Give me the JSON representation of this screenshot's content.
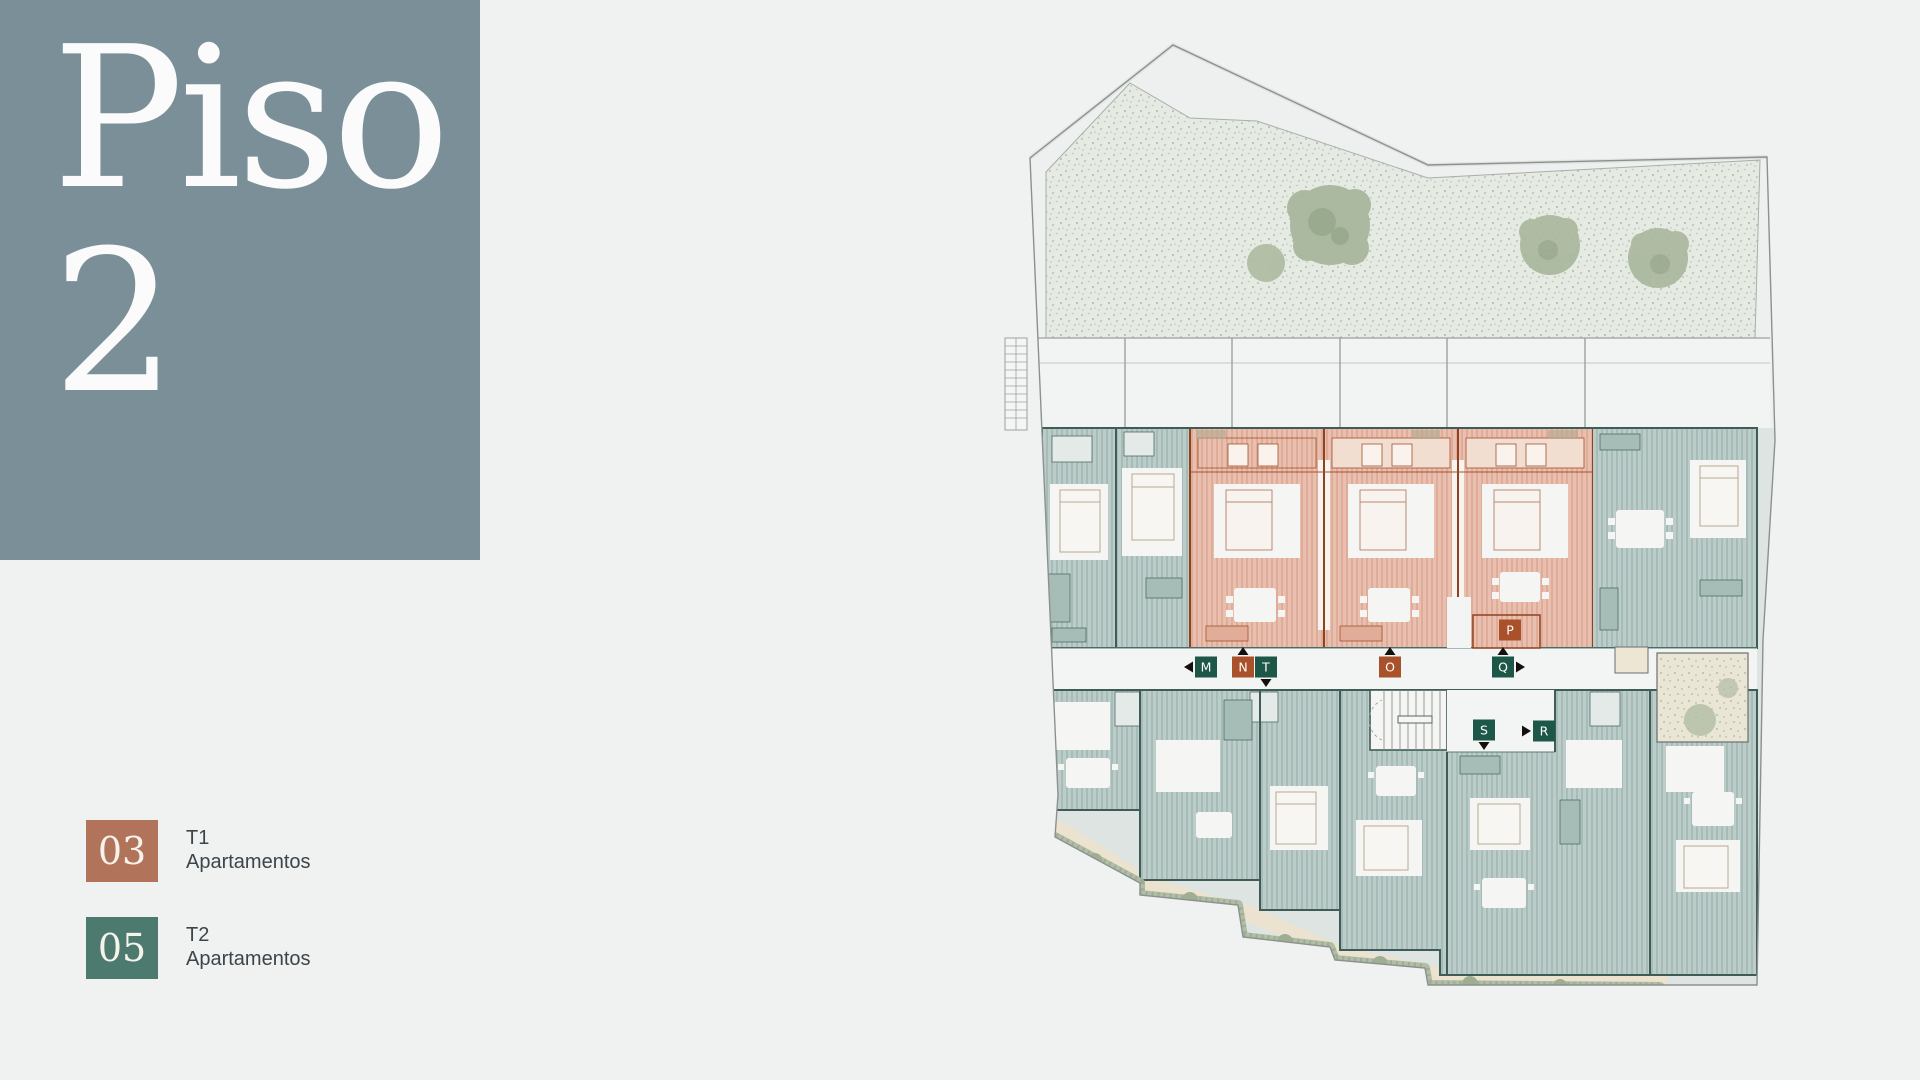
{
  "title_panel": {
    "line1": "Piso",
    "line2": "2",
    "background": "#7b8f99",
    "text_color": "#fafbfa"
  },
  "legend": {
    "items": [
      {
        "number": "03",
        "type_label": "T1",
        "category": "Apartamentos",
        "color": "#b1735a"
      },
      {
        "number": "05",
        "type_label": "T2",
        "category": "Apartamentos",
        "color": "#4d7a6e"
      }
    ]
  },
  "plan": {
    "label_colors": {
      "teal": "#1d5747",
      "orange": "#a9512a"
    },
    "unit_labels": [
      {
        "letter": "M",
        "style": "teal",
        "x": 206,
        "y": 627,
        "arrows": [
          "left"
        ]
      },
      {
        "letter": "N",
        "style": "orange",
        "x": 243,
        "y": 627,
        "arrows": [
          "up"
        ]
      },
      {
        "letter": "T",
        "style": "teal",
        "x": 266,
        "y": 627,
        "arrows": [
          "down"
        ]
      },
      {
        "letter": "O",
        "style": "orange",
        "x": 390,
        "y": 627,
        "arrows": [
          "up"
        ]
      },
      {
        "letter": "P",
        "style": "orange",
        "x": 510,
        "y": 590,
        "arrows": []
      },
      {
        "letter": "Q",
        "style": "teal",
        "x": 503,
        "y": 627,
        "arrows": [
          "up",
          "right"
        ]
      },
      {
        "letter": "S",
        "style": "teal",
        "x": 484,
        "y": 690,
        "arrows": [
          "down"
        ]
      },
      {
        "letter": "R",
        "style": "teal",
        "x": 544,
        "y": 691,
        "arrows": [
          "lead-right"
        ]
      }
    ]
  }
}
